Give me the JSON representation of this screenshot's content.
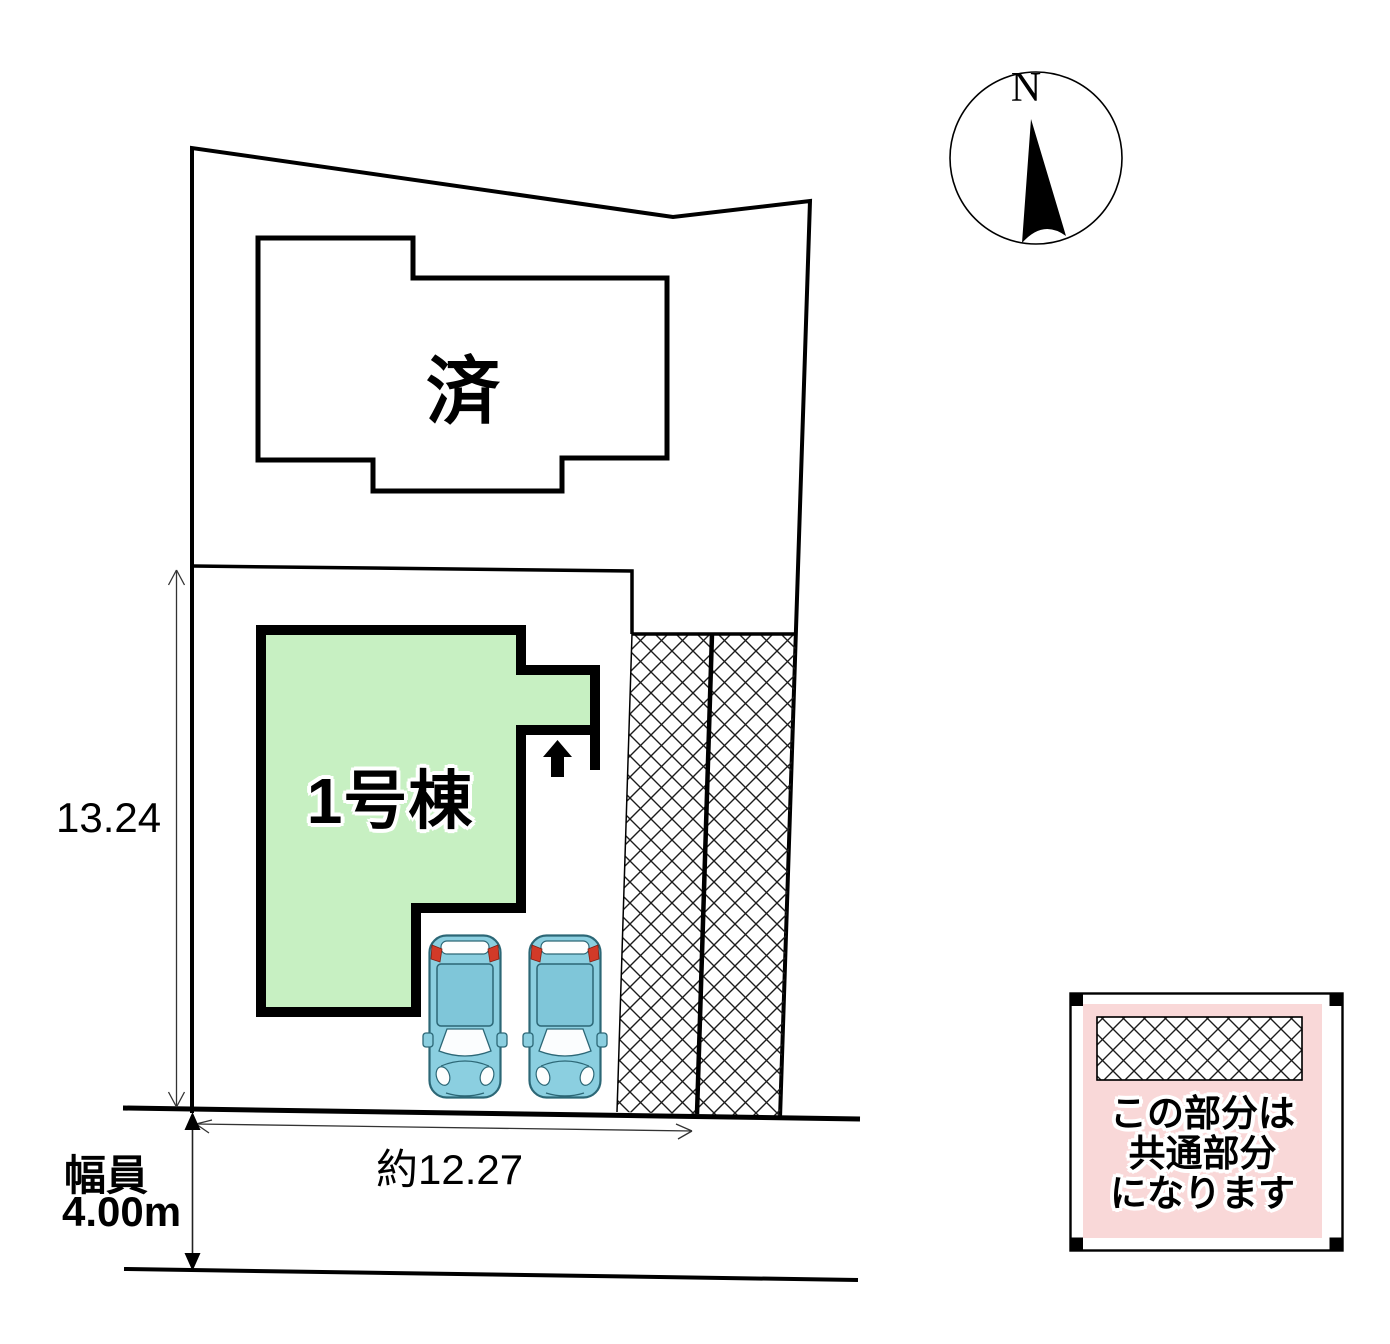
{
  "plan": {
    "units": {
      "sold_label": "済",
      "unit1_label": "1号棟"
    },
    "dimensions": {
      "depth": "13.24",
      "frontage": "約12.27",
      "road_width_label": "幅員",
      "road_width_value": "4.00m"
    },
    "compass": {
      "north": "N"
    },
    "legend": {
      "line1": "この部分は",
      "line2": "共通部分",
      "line3": "になります"
    },
    "colors": {
      "unit_green": "#c7f0c2",
      "legend_pink": "#f9d8d8",
      "car_blue": "#8bcfe0",
      "car_roof_blue": "#7fc6d9",
      "car_red": "#d23a28",
      "line_black": "#000000"
    }
  }
}
